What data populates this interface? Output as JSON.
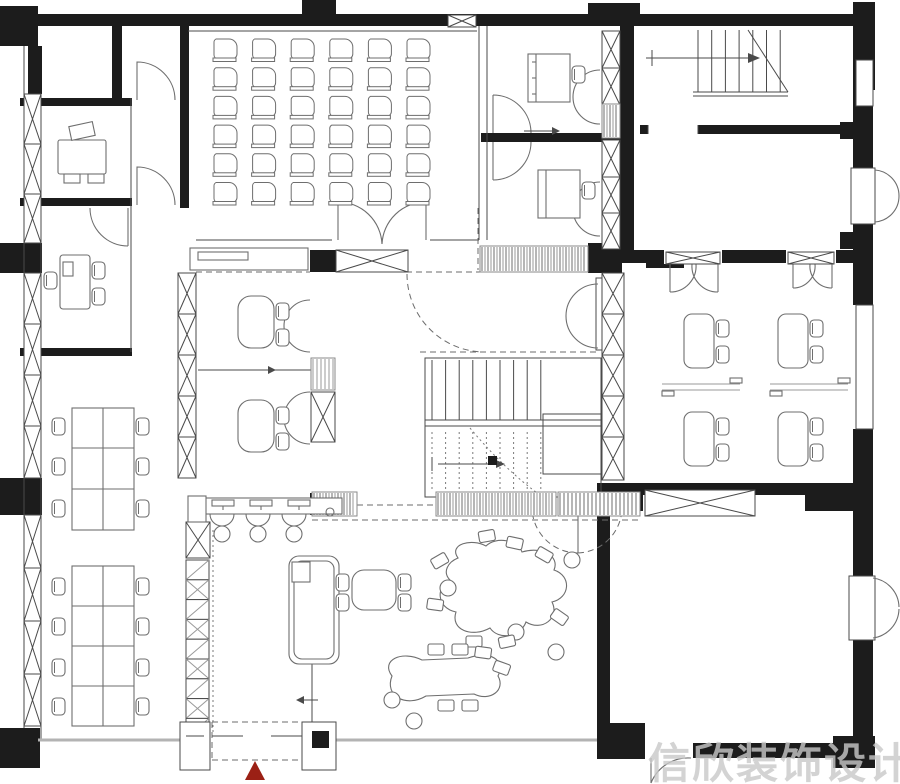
{
  "title": "office floor plan",
  "watermark": {
    "text": "信欣装饰设计",
    "color": "#c9c9c9"
  },
  "entrance": {
    "marker": "red-triangle",
    "color": "#9b2015"
  },
  "palette": {
    "wall": "#1c1c1c",
    "thin_line": "#4a4a4a",
    "furniture_line": "#6e6e6e",
    "hatch": "#999999",
    "background": "#ffffff"
  },
  "counts": {
    "classroom_chairs": 36,
    "classroom_grid": "6x6",
    "long_table_a_seats": 6,
    "long_table_b_seats": 8,
    "right_room_workstations": 4,
    "reception_stations": 3,
    "staircases": 2
  },
  "rooms": [
    "private-office",
    "private-office",
    "private-office",
    "classroom",
    "small-office",
    "small-office",
    "stair-hall",
    "meeting-room",
    "open-plan-office",
    "team-table-area",
    "reception",
    "lounge",
    "large-empty-hall",
    "central-stairwell"
  ]
}
